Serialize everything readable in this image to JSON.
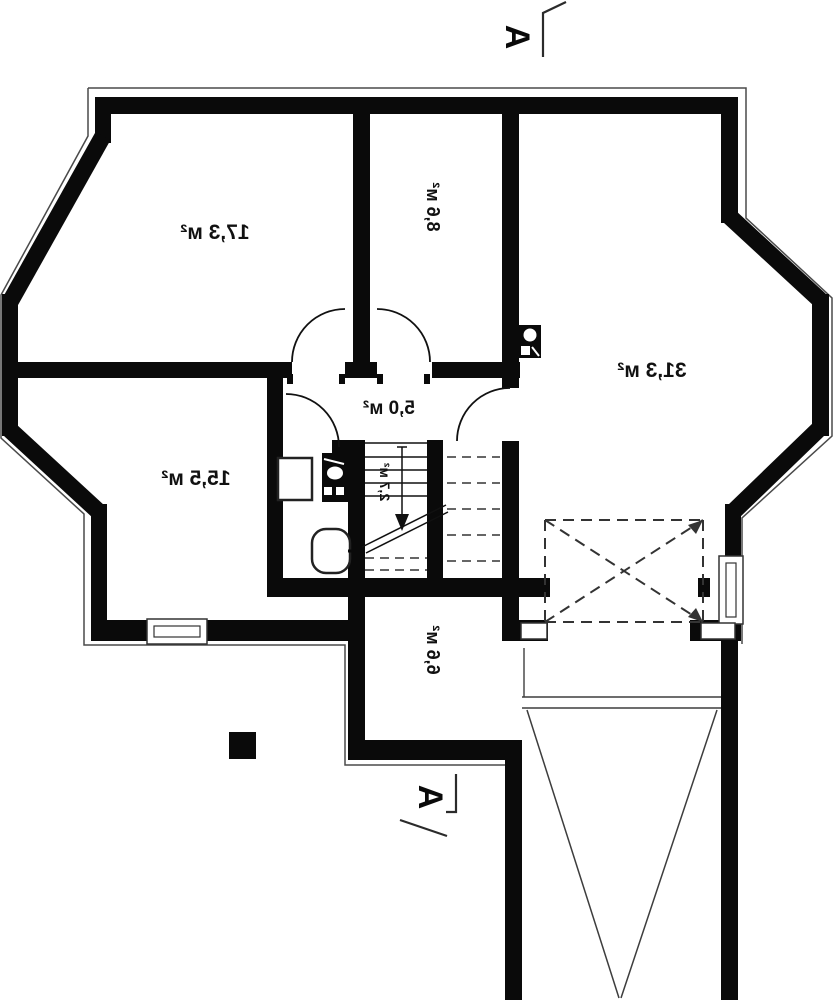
{
  "plan": {
    "type": "floor-plan",
    "mirrored": true,
    "section_markers": {
      "top": "A",
      "bottom": "A"
    },
    "rooms": [
      {
        "name": "room-17-3",
        "area_label": "17,3 м²"
      },
      {
        "name": "room-8-6",
        "area_label": "8,6 м²"
      },
      {
        "name": "room-31-3",
        "area_label": "31,3 м²"
      },
      {
        "name": "room-15-5",
        "area_label": "15,5 м²"
      },
      {
        "name": "hallway",
        "area_label": "5,0 м²"
      },
      {
        "name": "stairs",
        "area_label": "2,7 м²"
      },
      {
        "name": "room-6-6",
        "area_label": "6,6 м²"
      }
    ],
    "colors": {
      "wall": "#0a0a0a",
      "line": "#3d3d3d",
      "background": "#ffffff"
    }
  }
}
